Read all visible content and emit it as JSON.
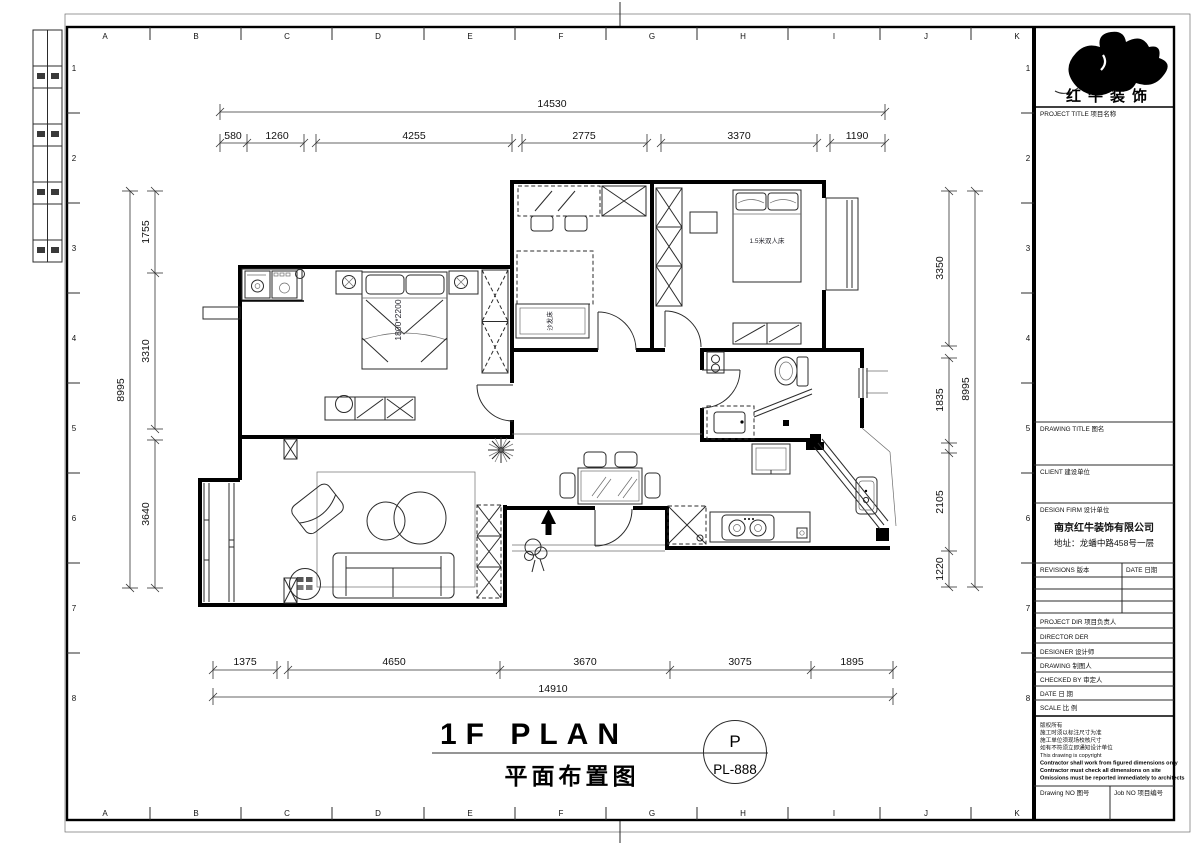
{
  "sheet": {
    "grid_letters": [
      "A",
      "B",
      "C",
      "D",
      "E",
      "F",
      "G",
      "H",
      "I",
      "J",
      "K"
    ],
    "grid_numbers": [
      "1",
      "2",
      "3",
      "4",
      "5",
      "6",
      "7",
      "8"
    ]
  },
  "plan": {
    "title_en": "1F PLAN",
    "title_cn": "平面布置图",
    "stamp": {
      "letter": "P",
      "number": "PL-888"
    },
    "room_labels": {
      "master_bed_size": "1800*2200",
      "second_bed": "1.5米双人床",
      "sofa_bed": "沙发床"
    }
  },
  "dimensions": {
    "top": {
      "overall": "14530",
      "segments": [
        "580",
        "1260",
        "4255",
        "2775",
        "3370",
        "1190"
      ]
    },
    "bottom": {
      "overall": "14910",
      "segments": [
        "1375",
        "4650",
        "3670",
        "3075",
        "1895"
      ]
    },
    "left": {
      "overall": "8995",
      "segments": [
        "1755",
        "3310",
        "3640"
      ]
    },
    "right": {
      "overall": "8995",
      "segments": [
        "3350",
        "1835",
        "2105",
        "1220"
      ]
    }
  },
  "title_block": {
    "brand": "红牛装饰",
    "project_title": "PROJECT TITLE  项目名称",
    "drawing_title": "DRAWING TITLE  图名",
    "client": "CLIENT  建设单位",
    "design_firm": "DESIGN FIRM  设计单位",
    "firm_name": "南京红牛装饰有限公司",
    "firm_address": "地址：龙蟠中路458号一层",
    "revisions": "REVISIONS 版本",
    "revisions_date": "DATE 日期",
    "project_dir": "PROJECT DIR  项目负责人",
    "director": "DIRECTOR DER",
    "designer": "DESIGNER  设计师",
    "drawing": "DRAWING  制图人",
    "checked_by": "CHECKED BY  审定人",
    "date": "DATE  日 期",
    "scale": "SCALE  比 例",
    "notes": [
      "版权所有",
      "施工时须以标注尺寸为准",
      "施工单位须现场校核尺寸",
      "如有不符须立即通知设计单位",
      "This drawing is copyright",
      "Contractor shall work from figured dimensions only",
      "Contractor must check all dimensions on site",
      "Omissions must be reported immediately to architects"
    ],
    "drawing_no": "Drawing NO 图号",
    "job_no": "Job NO 项目编号"
  }
}
